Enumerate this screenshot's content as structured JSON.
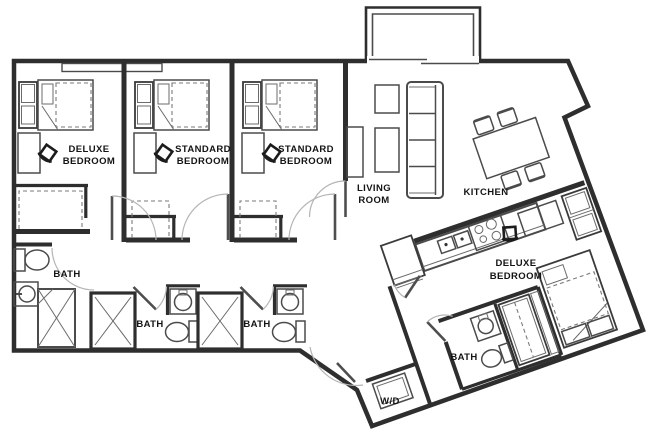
{
  "palette": {
    "wall": "#2e2e2e",
    "furniture": "#4b4b4b",
    "door_arc": "#b5b5b5",
    "text": "#141414",
    "background": "#ffffff"
  },
  "labels": {
    "bedroom1": {
      "line1": "DELUXE",
      "line2": "BEDROOM"
    },
    "bedroom2": {
      "line1": "STANDARD",
      "line2": "BEDROOM"
    },
    "bedroom3": {
      "line1": "STANDARD",
      "line2": "BEDROOM"
    },
    "living_room": {
      "line1": "LIVING",
      "line2": "ROOM"
    },
    "kitchen": {
      "label": "KITCHEN"
    },
    "bath1": {
      "label": "BATH"
    },
    "bath2": {
      "label": "BATH"
    },
    "bath3": {
      "label": "BATH"
    },
    "bath4": {
      "label": "BATH"
    },
    "bedroom4": {
      "line1": "DELUXE",
      "line2": "BEDROOM"
    },
    "laundry": {
      "label": "W/D"
    }
  }
}
